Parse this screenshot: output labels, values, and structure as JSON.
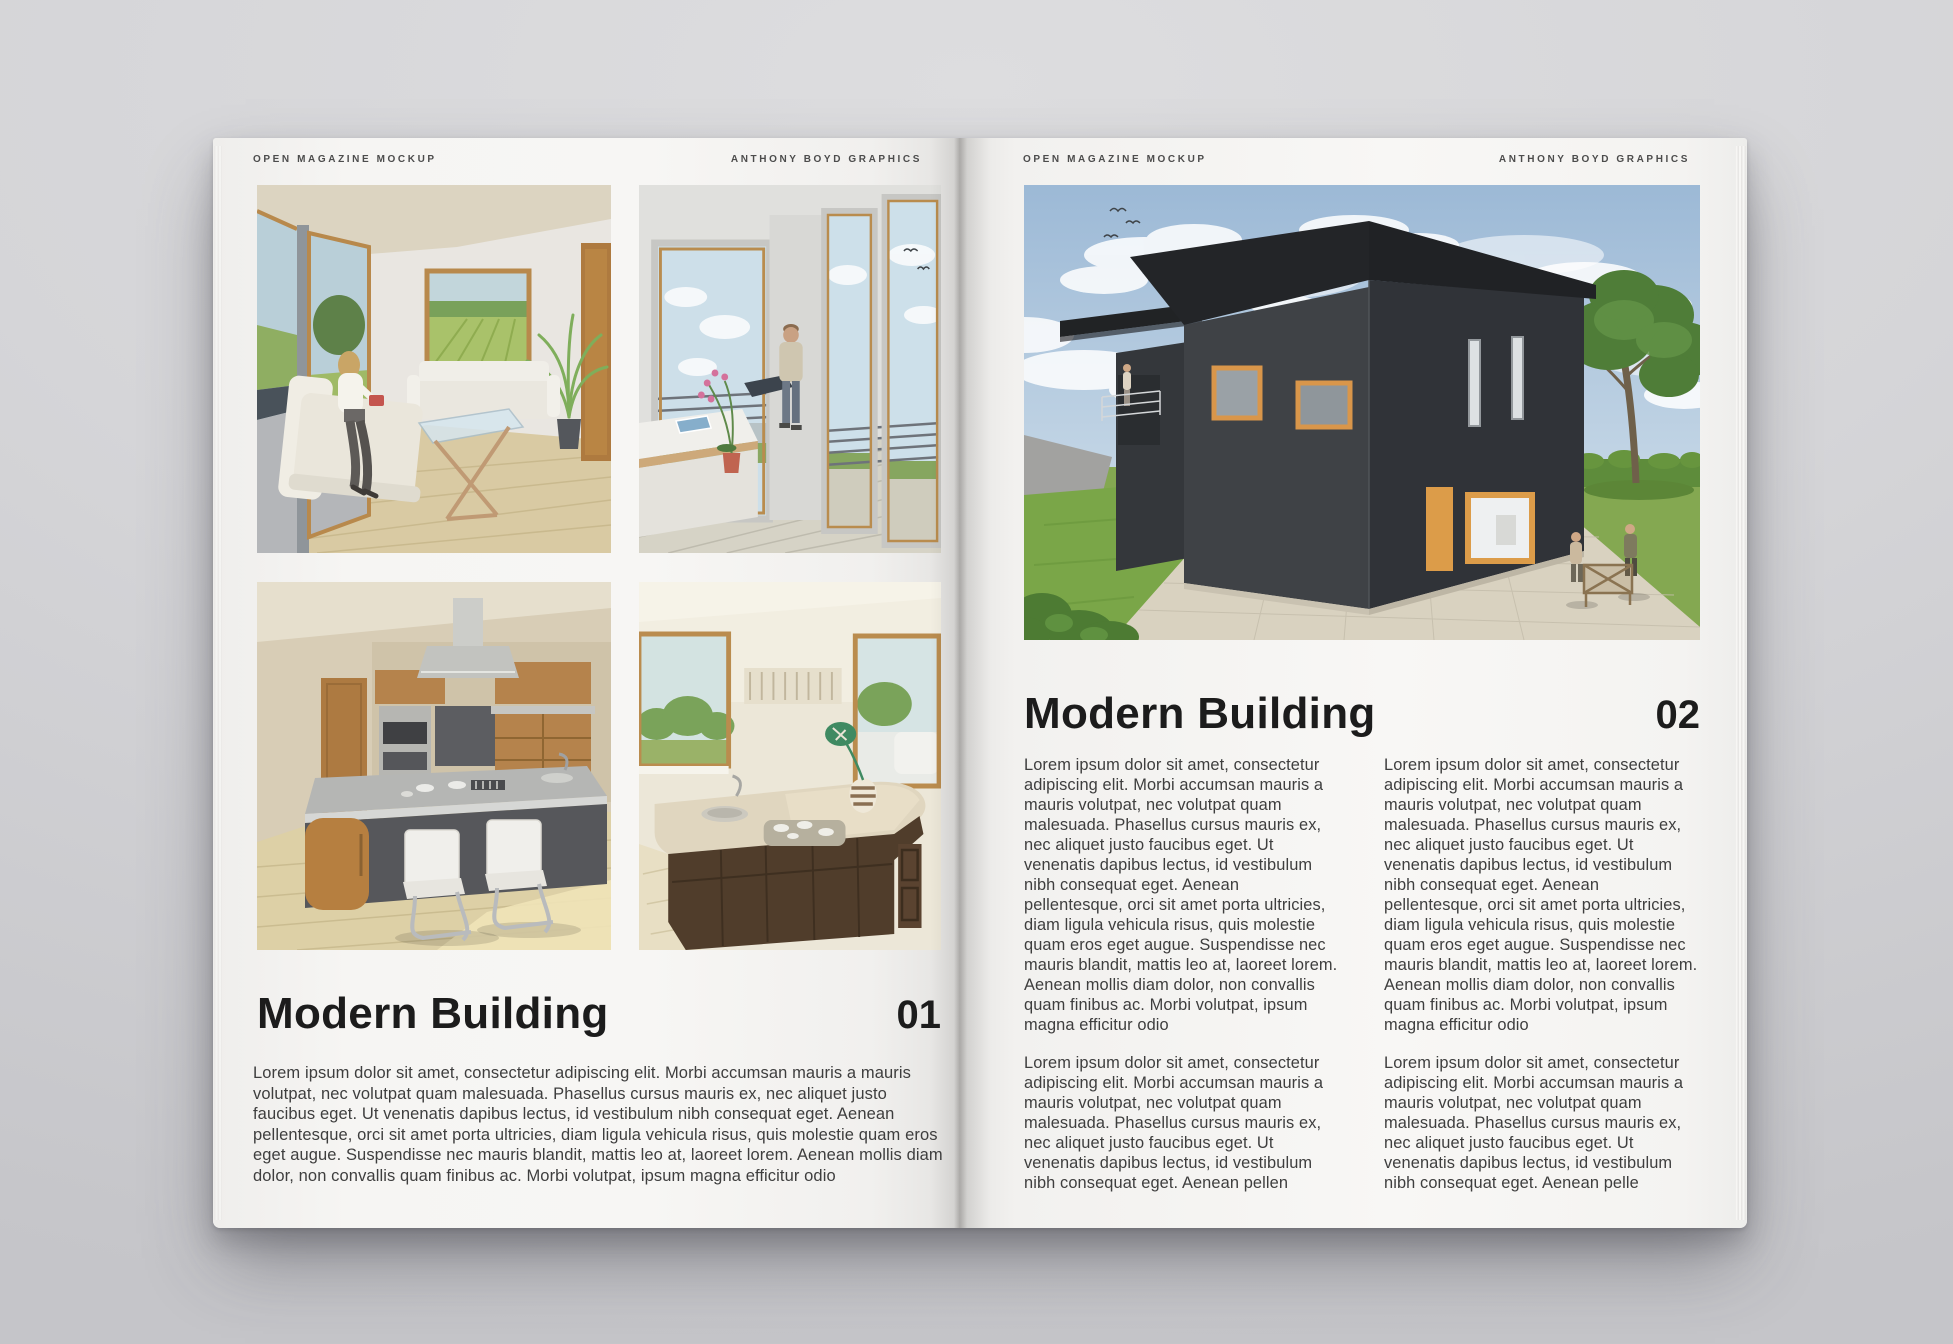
{
  "background": {
    "desk_color": "#d4d4d7"
  },
  "spread": {
    "colors": {
      "page": "#f5f4f2",
      "heading_text": "#1c1c1c",
      "body_text": "#3e3e3e",
      "running_head_text": "#4c4c4c",
      "house_cladding": "#3a3d41",
      "accent_window_frame": "#dc9c49"
    },
    "left_page": {
      "running_head_left": "OPEN MAGAZINE MOCKUP",
      "running_head_right": "ANTHONY BOYD GRAPHICS",
      "article": {
        "title": "Modern Building",
        "number": "01",
        "body": "Lorem ipsum dolor sit amet, consectetur adipiscing elit. Morbi accumsan mauris a mauris volutpat, nec volutpat quam malesuada. Phasellus cursus mauris ex, nec aliquet justo faucibus eget. Ut venenatis dapibus lectus, id vestibulum nibh consequat eget. Aenean pellentesque, orci sit amet porta ultricies, diam ligula vehicula risus, quis molestie quam eros eget augue. Suspendisse nec mauris blandit, mattis leo at, laoreet lorem. Aenean mollis diam dolor, non convallis quam finibus ac. Morbi volutpat, ipsum magna efficitur odio"
      },
      "photos": [
        {
          "name": "living-room-render",
          "description": "Living room with white sofas, woman reading, glass coffee table, garden view windows, potted palm"
        },
        {
          "name": "balcony-render",
          "description": "Balcony with tall glazed doors, railing, child walking, orchid on white desk"
        },
        {
          "name": "kitchen-island-render",
          "description": "Kitchen with steel-top island, two white cantilever bar chairs, wood cabinets and hood"
        },
        {
          "name": "kitchen-counter-render",
          "description": "Kitchen counter with sink, hob, striped vase with green leaf, garden view windows"
        }
      ]
    },
    "right_page": {
      "running_head_left": "OPEN MAGAZINE MOCKUP",
      "running_head_right": "ANTHONY BOYD GRAPHICS",
      "photo": {
        "name": "modern-house-exterior-render",
        "description": "Black modern house with mono-pitched roof, orange framed windows and door, paved patio, lawn, hedge and tree under a cloudy blue sky"
      },
      "article": {
        "title": "Modern Building",
        "number": "02",
        "columns": [
          {
            "paragraphs": [
              "Lorem ipsum dolor sit amet, consectetur adipiscing elit. Morbi accumsan mauris a mauris volutpat, nec volutpat quam malesuada. Phasellus cursus mauris ex, nec aliquet justo faucibus eget. Ut venenatis dapibus lectus, id vestibulum nibh consequat eget. Aenean pellentesque, orci sit amet porta ultricies, diam ligula vehicula risus, quis molestie quam eros eget augue. Suspendisse nec mauris blandit, mattis leo at, laoreet lorem. Aenean mollis diam dolor, non convallis quam finibus ac. Morbi volutpat, ipsum magna efficitur odio",
              "Lorem ipsum dolor sit amet, consectetur adipiscing elit. Morbi accumsan mauris a mauris volutpat, nec volutpat quam malesuada. Phasellus cursus mauris ex, nec aliquet justo faucibus eget. Ut venenatis dapibus lectus, id vestibulum nibh consequat eget. Aenean pellen"
            ]
          },
          {
            "paragraphs": [
              "Lorem ipsum dolor sit amet, consectetur adipiscing elit. Morbi accumsan mauris a mauris volutpat, nec volutpat quam malesuada. Phasellus cursus mauris ex, nec aliquet justo faucibus eget. Ut venenatis dapibus lectus, id vestibulum nibh consequat eget. Aenean pellentesque, orci sit amet porta ultricies, diam ligula vehicula risus, quis molestie quam eros eget augue. Suspendisse nec mauris blandit, mattis leo at, laoreet lorem. Aenean mollis diam dolor, non convallis quam finibus ac. Morbi volutpat, ipsum magna efficitur odio",
              "Lorem ipsum dolor sit amet, consectetur adipiscing elit. Morbi accumsan mauris a mauris volutpat, nec volutpat quam malesuada. Phasellus cursus mauris ex, nec aliquet justo faucibus eget. Ut venenatis dapibus lectus, id vestibulum nibh consequat eget. Aenean pelle"
            ]
          }
        ]
      }
    }
  }
}
